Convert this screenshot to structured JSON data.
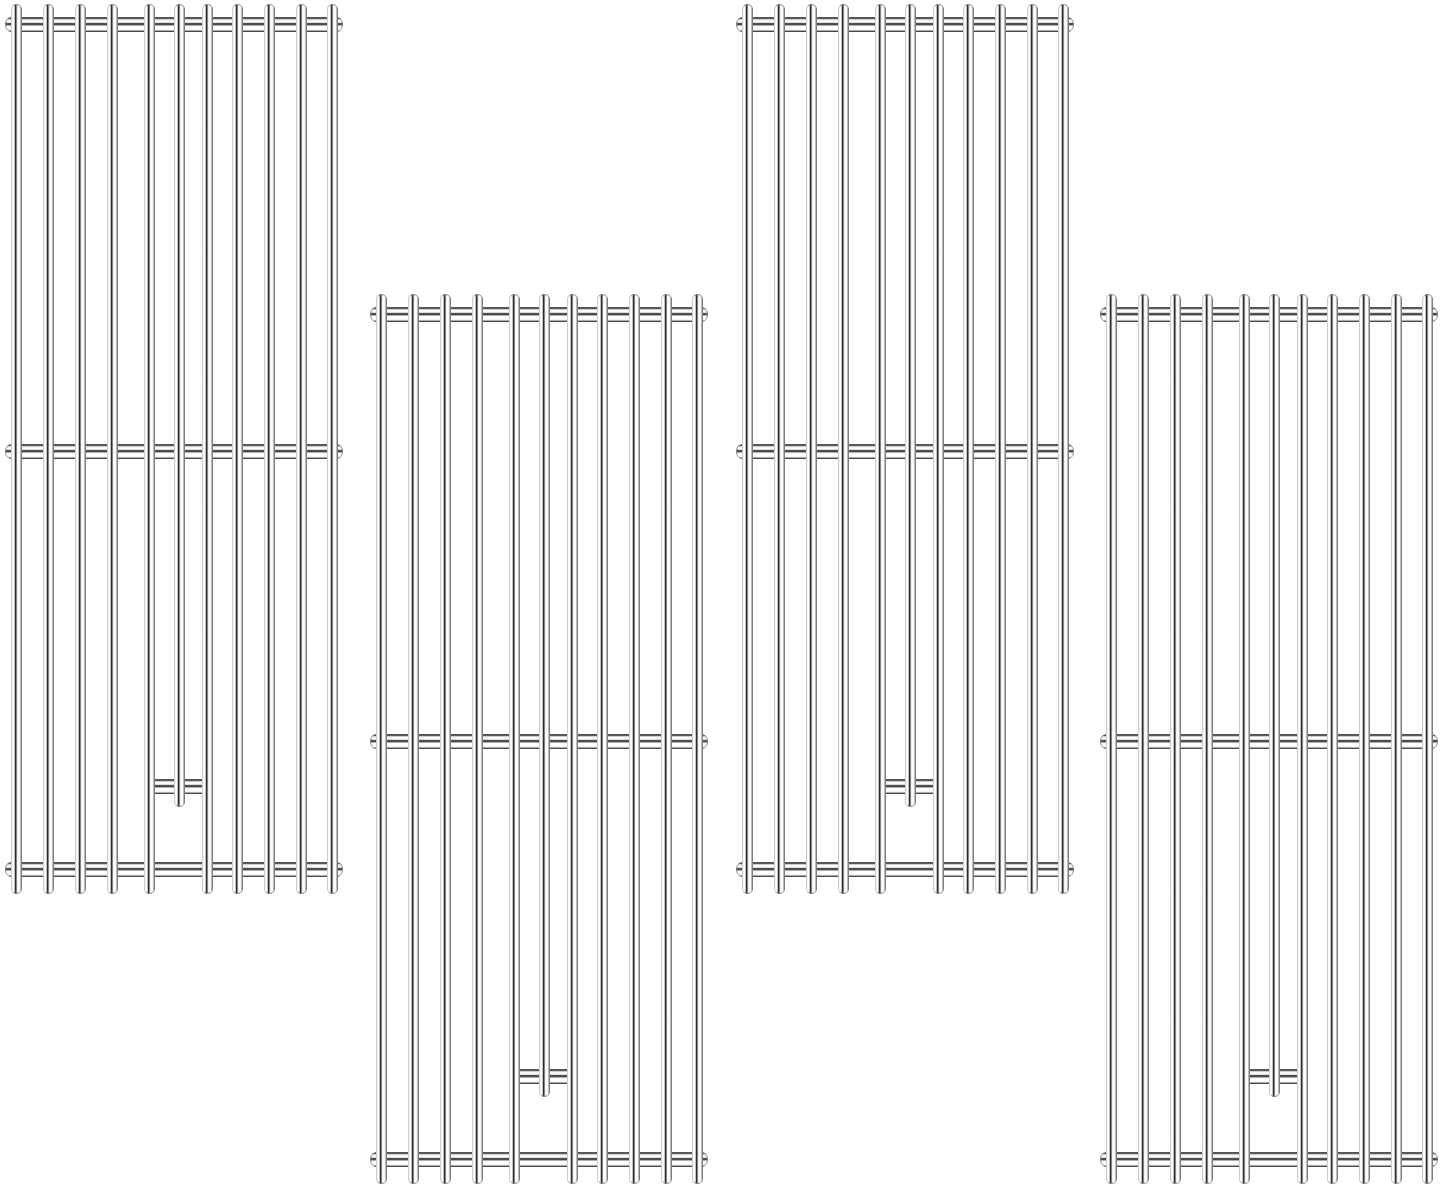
{
  "scene": {
    "description": "Product image of four identical stainless steel replacement grill cooking grate panels on a white background, arranged alternately high and low",
    "background_color": "#ffffff",
    "panel_count": 4,
    "panels": [
      {
        "id": "grate-1",
        "x": 5,
        "y": 4
      },
      {
        "id": "grate-2",
        "x": 370,
        "y": 294
      },
      {
        "id": "grate-3",
        "x": 736,
        "y": 4
      },
      {
        "id": "grate-4",
        "x": 1100,
        "y": 294
      }
    ],
    "grate_design": {
      "width": 338,
      "height": 890,
      "rod_count": 11,
      "rod_width": 11,
      "first_rod_center": 11,
      "rod_center_offsets": [
        0,
        32,
        64,
        96,
        133,
        163,
        191,
        221,
        253,
        285,
        316
      ],
      "short_rod_index": 5,
      "short_rod_height": 803,
      "crossbar_thickness": 15,
      "crossbars_y": [
        13,
        440,
        858
      ],
      "stub_crossbar": {
        "y": 775,
        "from_rod_index": 4,
        "to_rod_index": 6,
        "overhang": 4
      }
    },
    "colors": {
      "background": "#ffffff",
      "steel_highlight": "#ffffff",
      "steel_light": "#e8e8e8",
      "steel_mid": "#9a9a9a",
      "steel_dark": "#2a2a2a"
    }
  }
}
